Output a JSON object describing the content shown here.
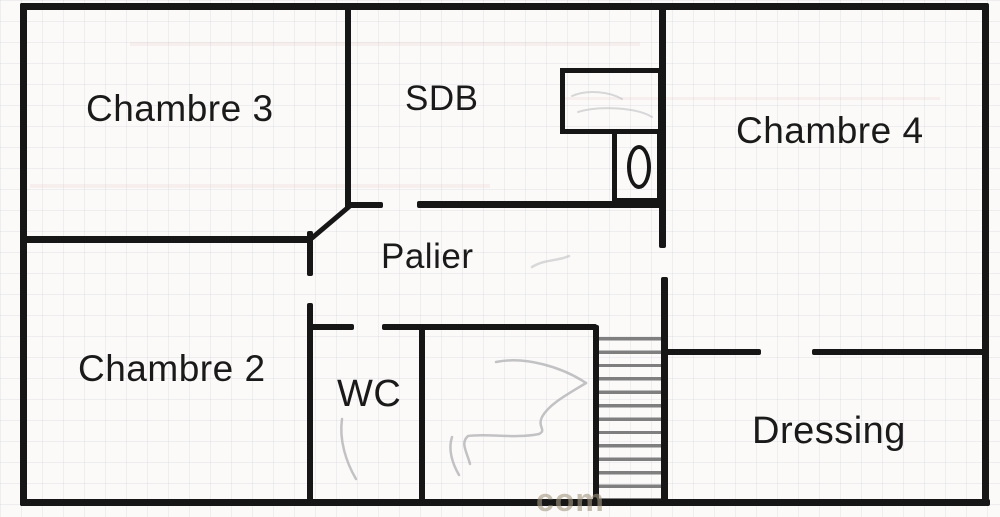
{
  "plan": {
    "type": "floor-plan",
    "rooms": [
      {
        "id": "chambre-3",
        "label": "Chambre 3"
      },
      {
        "id": "sdb",
        "label": "SDB"
      },
      {
        "id": "chambre-4",
        "label": "Chambre 4"
      },
      {
        "id": "palier",
        "label": "Palier"
      },
      {
        "id": "chambre-2",
        "label": "Chambre 2"
      },
      {
        "id": "wc",
        "label": "WC"
      },
      {
        "id": "dressing",
        "label": "Dressing"
      }
    ],
    "fixtures": [
      "staircase",
      "toilet",
      "bathroom-counter"
    ],
    "watermark": "com",
    "colors": {
      "wall": "#161616",
      "background": "#fbfaf8",
      "grid_line": "#c9cdd8",
      "stair_tread": "#7f7f7f",
      "pencil_mark": "#b4b4b8",
      "watermark": "#a49880"
    }
  }
}
